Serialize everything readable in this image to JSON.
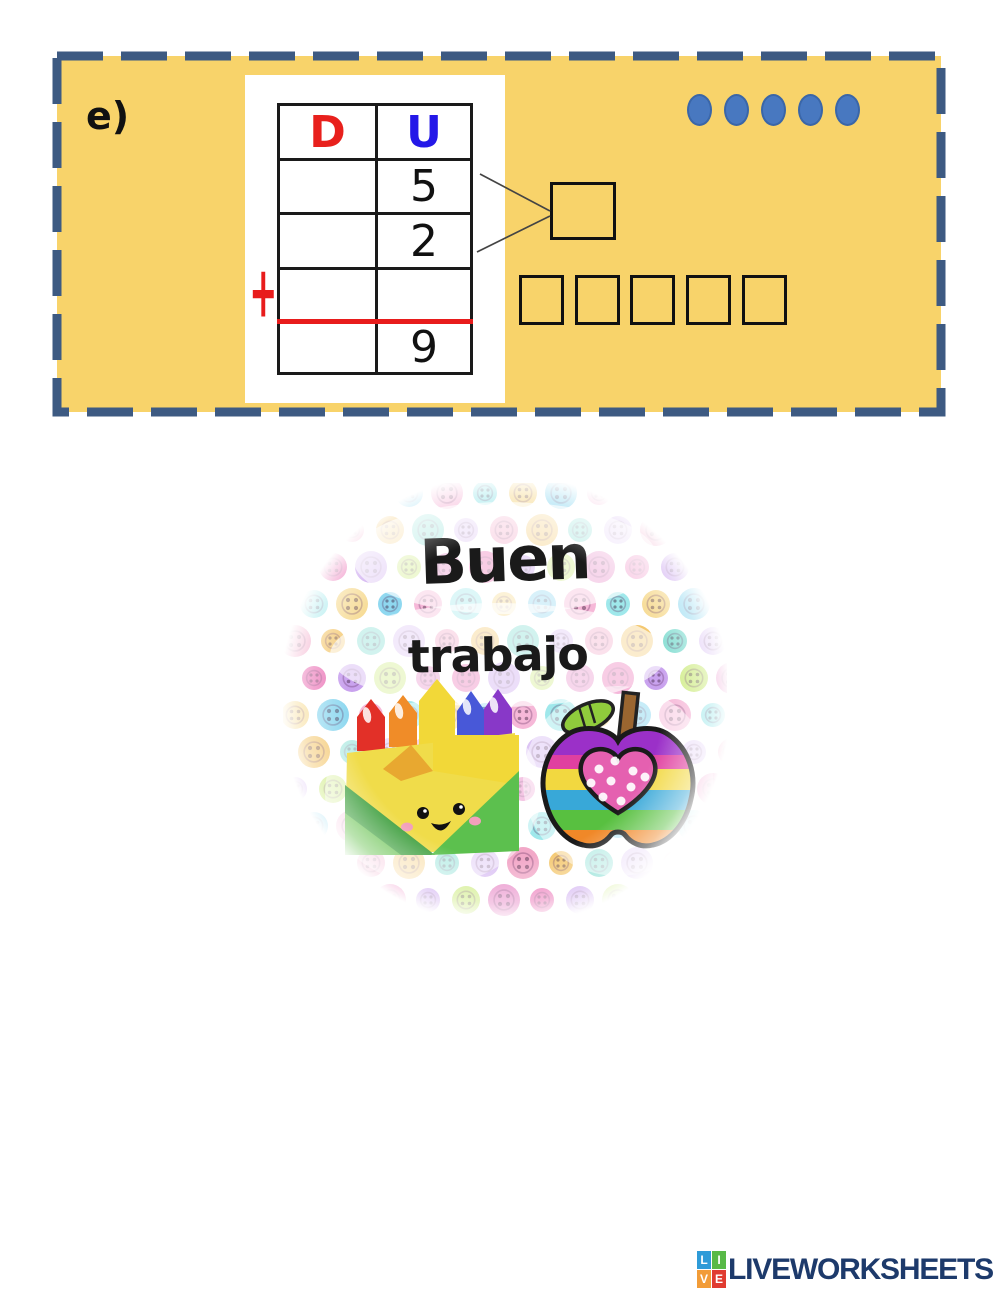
{
  "exercise": {
    "item_label": "e)",
    "plus_sign": "+",
    "table": {
      "headers": [
        {
          "label": "D",
          "color": "#e8201c"
        },
        {
          "label": "U",
          "color": "#2418e8"
        }
      ],
      "rows": [
        {
          "d": "",
          "u": "5"
        },
        {
          "d": "",
          "u": "2"
        },
        {
          "d": "",
          "u": ""
        },
        {
          "d": "",
          "u": "9"
        }
      ],
      "sum_line_color": "#e81c1c"
    },
    "counter_dots": {
      "count": 5,
      "fill": "#4878c0"
    },
    "answer_boxes": {
      "result_box_count": 1,
      "small_box_count": 5
    },
    "colors": {
      "card_bg": "#f8d36a",
      "card_border": "#3d5a82",
      "table_line": "#1a1a1a"
    }
  },
  "badge": {
    "line1": "Buen",
    "line2": "trabajo",
    "palette": [
      "#f6b8d8",
      "#ea6fb4",
      "#7fdcd0",
      "#9fe8eb",
      "#c9a2ee",
      "#dcc4f4",
      "#f6d98e",
      "#cdeb80",
      "#f2a8c8",
      "#8fd8f0",
      "#e88cc8",
      "#f4c870"
    ]
  },
  "footer_logo": {
    "text": "LIVEWORKSHEETS",
    "text_color": "#1d3a6b",
    "tiles": [
      {
        "letter": "L",
        "color": "#2e9bd8"
      },
      {
        "letter": "I",
        "color": "#58b947"
      },
      {
        "letter": "V",
        "color": "#f29c38"
      },
      {
        "letter": "E",
        "color": "#e03c31"
      }
    ]
  }
}
